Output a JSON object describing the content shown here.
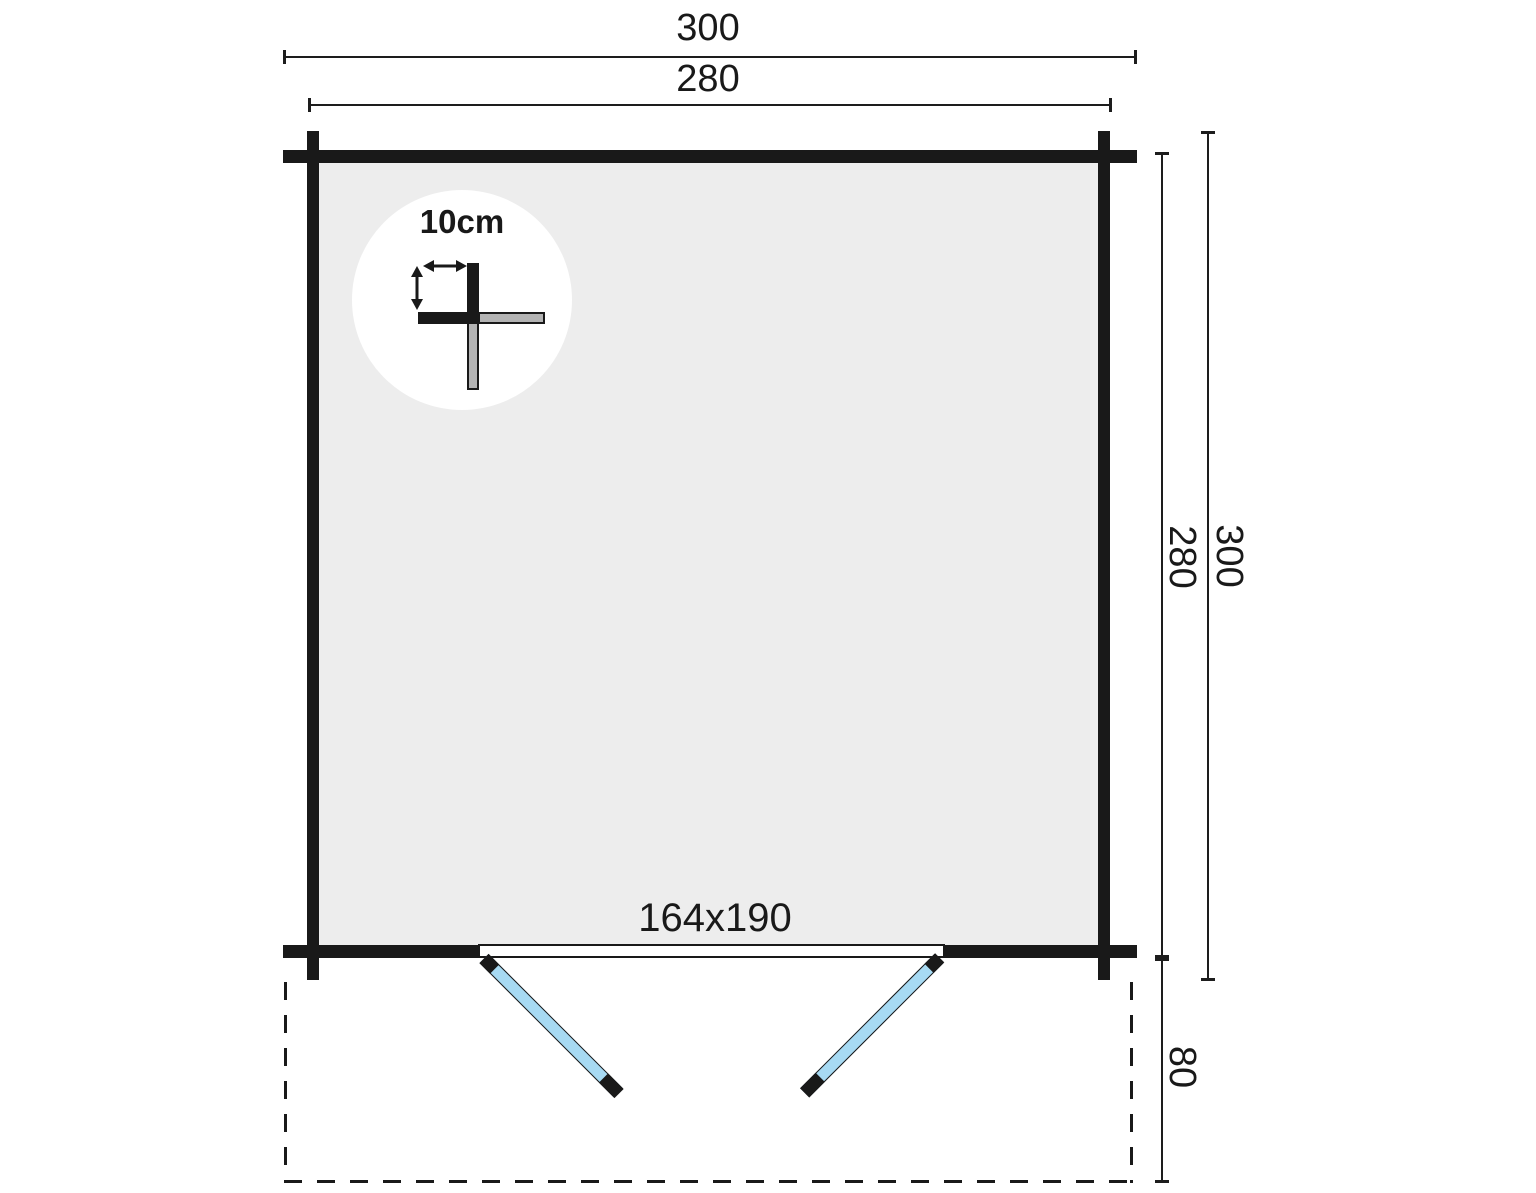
{
  "diagram": {
    "type": "floor-plan",
    "labels": {
      "outer_width": "300",
      "inner_width": "280",
      "outer_depth": "300",
      "inner_depth": "280",
      "porch_depth": "80",
      "door_size": "164x190",
      "wall_thickness": "10cm"
    },
    "colors": {
      "ink": "#191919",
      "floor": "#EDEDED",
      "door": "#A7DAF3",
      "log": "#B3B3B3",
      "bg": "#FFFFFF"
    }
  }
}
